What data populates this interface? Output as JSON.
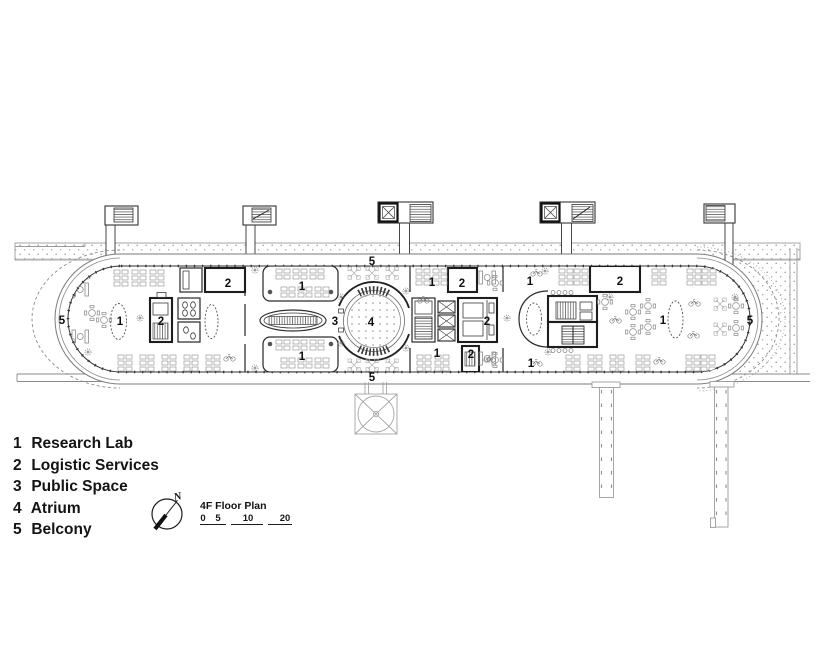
{
  "plan_title": "4F Floor Plan",
  "compass": {
    "label": "N"
  },
  "scale_bar": {
    "ticks": [
      "0",
      "5",
      "10",
      "20"
    ]
  },
  "legend": {
    "items": [
      {
        "num": "1",
        "name": "Research Lab"
      },
      {
        "num": "2",
        "name": "Logistic Services"
      },
      {
        "num": "3",
        "name": "Public Space"
      },
      {
        "num": "4",
        "name": "Atrium"
      },
      {
        "num": "5",
        "name": "Belcony"
      }
    ]
  },
  "plan": {
    "room_labels": [
      {
        "text": "5",
        "x": 62,
        "y": 324
      },
      {
        "text": "1",
        "x": 120,
        "y": 325
      },
      {
        "text": "2",
        "x": 161,
        "y": 325
      },
      {
        "text": "2",
        "x": 228,
        "y": 287
      },
      {
        "text": "1",
        "x": 302,
        "y": 290
      },
      {
        "text": "1",
        "x": 302,
        "y": 360
      },
      {
        "text": "3",
        "x": 335,
        "y": 325
      },
      {
        "text": "4",
        "x": 371,
        "y": 326
      },
      {
        "text": "5",
        "x": 372,
        "y": 265
      },
      {
        "text": "5",
        "x": 372,
        "y": 381
      },
      {
        "text": "1",
        "x": 432,
        "y": 286
      },
      {
        "text": "2",
        "x": 462,
        "y": 287
      },
      {
        "text": "2",
        "x": 487,
        "y": 325
      },
      {
        "text": "1",
        "x": 437,
        "y": 357
      },
      {
        "text": "2",
        "x": 471,
        "y": 358
      },
      {
        "text": "1",
        "x": 530,
        "y": 285
      },
      {
        "text": "1",
        "x": 531,
        "y": 367
      },
      {
        "text": "2",
        "x": 620,
        "y": 285
      },
      {
        "text": "1",
        "x": 663,
        "y": 324
      },
      {
        "text": "5",
        "x": 750,
        "y": 324
      }
    ]
  }
}
